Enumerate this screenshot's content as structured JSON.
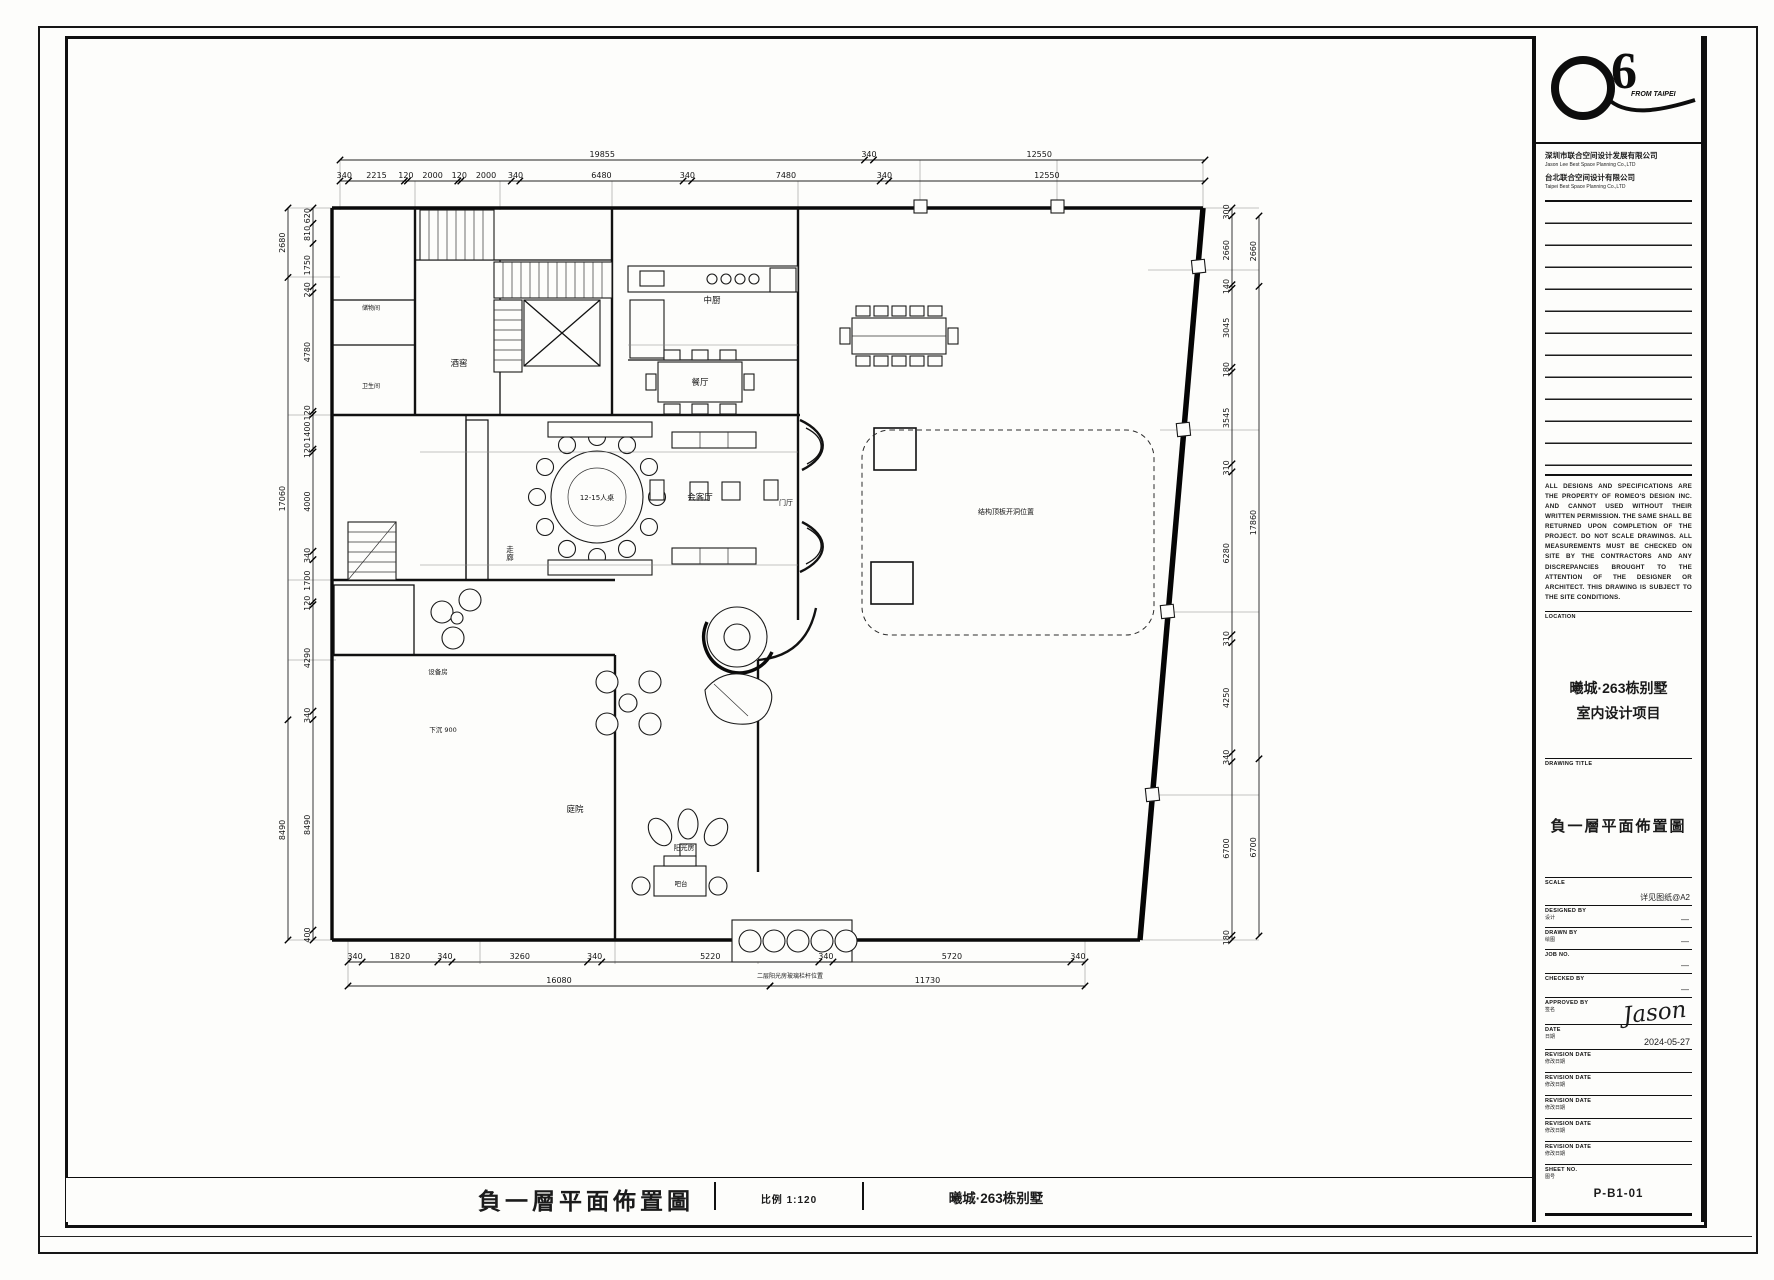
{
  "title_block": {
    "logo": {
      "number": "6",
      "tagline": "FROM TAIPEI"
    },
    "company": {
      "line1_zh": "深圳市联合空间设计发展有限公司",
      "line1_en": "Jason Lee Best Space Planning Co.,LTD",
      "line2_zh": "台北联合空间设计有限公司",
      "line2_en": "Taipei Best Space Planning Co.,LTD"
    },
    "disclaimer": "ALL DESIGNS AND SPECIFICATIONS ARE THE PROPERTY OF ROMEO'S DESIGN INC. AND CANNOT USED WITHOUT THEIR WRITTEN PERMISSION. THE SAME SHALL BE RETURNED UPON COMPLETION OF THE PROJECT. DO NOT SCALE DRAWINGS. ALL MEASUREMENTS MUST BE CHECKED ON SITE BY THE CONTRACTORS AND ANY DISCREPANCIES BROUGHT TO THE ATTENTION OF THE DESIGNER OR ARCHITECT. THIS DRAWING IS SUBJECT TO THE SITE CONDITIONS.",
    "location_label": "LOCATION",
    "project_line1": "曦城·263栋别墅",
    "project_line2": "室内设计项目",
    "drawing_title_label": "DRAWING TITLE",
    "drawing_title": "負一層平面佈置圖",
    "fields": {
      "scale_label": "SCALE",
      "scale_value": "详见图纸@A2",
      "designed_label": "DESIGNED BY",
      "designed_sub": "设计",
      "designed_value": "—",
      "drawn_label": "DRAWN BY",
      "drawn_sub": "绘图",
      "drawn_value": "—",
      "job_label": "JOB NO.",
      "job_value": "—",
      "checked_label": "CHECKED BY",
      "checked_value": "—",
      "approved_label": "APPROVED BY",
      "approved_sub": "签名",
      "approved_value": "Jason",
      "date_label": "DATE",
      "date_sub": "日期",
      "date_value": "2024-05-27",
      "revisions": [
        {
          "label": "REVISION DATE",
          "sub": "修改日期"
        },
        {
          "label": "REVISION DATE",
          "sub": "修改日期"
        },
        {
          "label": "REVISION DATE",
          "sub": "修改日期"
        },
        {
          "label": "REVISION DATE",
          "sub": "修改日期"
        },
        {
          "label": "REVISION DATE",
          "sub": "修改日期"
        }
      ],
      "sheet_label": "SHEET NO.",
      "sheet_sub": "图号",
      "sheet_value": "P-B1-01"
    }
  },
  "bottom_bar": {
    "title": "負一層平面佈置圖",
    "scale": "比例 1:120",
    "project": "曦城·263栋别墅"
  },
  "plan": {
    "chains": [
      {
        "id": "top-overall",
        "x1": 340,
        "y1": 160,
        "x2": 1205,
        "y2": 160,
        "values": [
          "19855",
          "340",
          "12550"
        ]
      },
      {
        "id": "top-detail",
        "x1": 340,
        "y1": 181,
        "x2": 1205,
        "y2": 181,
        "values": [
          "340",
          "2215",
          "120",
          "2000",
          "120",
          "2000",
          "340",
          "6480",
          "340",
          "7480",
          "340",
          "12550"
        ]
      },
      {
        "id": "left-outer",
        "x1": 288,
        "y1": 208,
        "x2": 288,
        "y2": 940,
        "values": [
          "2680",
          "17060",
          "8490"
        ]
      },
      {
        "id": "left-inner",
        "x1": 313,
        "y1": 208,
        "x2": 313,
        "y2": 940,
        "values": [
          "620",
          "810",
          "1750",
          "240",
          "4780",
          "120",
          "1400",
          "120",
          "4000",
          "340",
          "1700",
          "120",
          "4290",
          "340",
          "8490",
          "400"
        ]
      },
      {
        "id": "right-inner",
        "x1": 1232,
        "y1": 208,
        "x2": 1232,
        "y2": 940,
        "values": [
          "300",
          "2660",
          "140",
          "3045",
          "180",
          "3545",
          "310",
          "6280",
          "310",
          "4250",
          "340",
          "6700",
          "180"
        ]
      },
      {
        "id": "right-outer",
        "x1": 1259,
        "y1": 216,
        "x2": 1259,
        "y2": 936,
        "values": [
          "2660",
          "17860",
          "6700"
        ]
      },
      {
        "id": "bottom-detail",
        "x1": 348,
        "y1": 962,
        "x2": 1085,
        "y2": 962,
        "values": [
          "340",
          "1820",
          "340",
          "3260",
          "340",
          "5220",
          "340",
          "5720",
          "340"
        ]
      },
      {
        "id": "bottom-overall-left",
        "x1": 348,
        "y1": 986,
        "x2": 770,
        "y2": 986,
        "values": [
          "16080"
        ]
      },
      {
        "id": "bottom-overall-right",
        "x1": 770,
        "y1": 986,
        "x2": 1085,
        "y2": 986,
        "values": [
          "11730"
        ]
      }
    ],
    "labels": [
      {
        "t": "中厨",
        "x": 712,
        "y": 303
      },
      {
        "t": "餐厅",
        "x": 700,
        "y": 385
      },
      {
        "t": "酒窖",
        "x": 459,
        "y": 366
      },
      {
        "t": "储物间",
        "x": 371,
        "y": 310,
        "s": 6
      },
      {
        "t": "卫生间",
        "x": 371,
        "y": 388,
        "s": 6
      },
      {
        "t": "走廊",
        "x": 510,
        "y": 552,
        "v": true,
        "s": 7.5
      },
      {
        "t": "12-15人桌",
        "x": 597,
        "y": 500,
        "s": 7
      },
      {
        "t": "会客厅",
        "x": 700,
        "y": 500
      },
      {
        "t": "门厅",
        "x": 786,
        "y": 505,
        "s": 7
      },
      {
        "t": "设备房",
        "x": 438,
        "y": 674,
        "s": 6.5
      },
      {
        "t": "下沉 900",
        "x": 443,
        "y": 732,
        "s": 6.5
      },
      {
        "t": "庭院",
        "x": 575,
        "y": 812
      },
      {
        "t": "阳光房",
        "x": 684,
        "y": 850,
        "s": 7
      },
      {
        "t": "吧台",
        "x": 681,
        "y": 886,
        "s": 6.5
      },
      {
        "t": "结构顶板开洞位置",
        "x": 1006,
        "y": 514,
        "s": 7
      },
      {
        "t": "二层阳光房玻璃栏杆位置",
        "x": 790,
        "y": 978,
        "s": 6
      }
    ]
  }
}
